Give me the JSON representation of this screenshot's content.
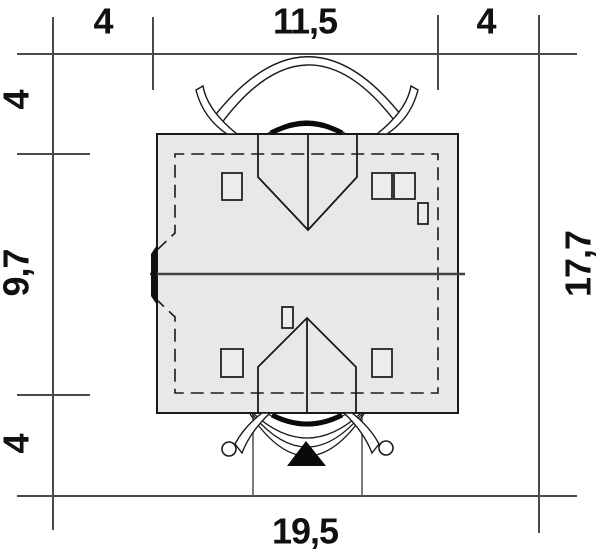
{
  "plan": {
    "type": "house-plot-roof-plan",
    "dimensions": {
      "top": [
        "4",
        "11,5",
        "4"
      ],
      "left": [
        "4",
        "9,7",
        "4"
      ],
      "right_total": "17,7",
      "bottom_total": "19,5"
    },
    "markers": {
      "entrance": "filled-triangle-arrow"
    },
    "colors": {
      "roof_fill": "#e8e8e8",
      "outline": "#1a1a1a",
      "dim_line": "#4a4a4a",
      "ridge": "#444444",
      "label": "#111111"
    }
  }
}
